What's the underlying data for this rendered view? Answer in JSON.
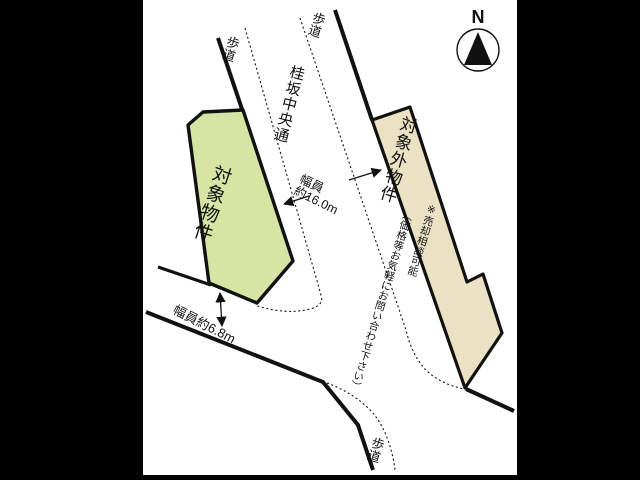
{
  "compass": {
    "north_label": "N"
  },
  "map": {
    "street_name": "桂坂中央通",
    "sidewalk_top_left": "歩道",
    "sidewalk_top_right": "歩道",
    "sidewalk_bottom": "歩道",
    "target_property": {
      "label": "対象物件",
      "fill": "#d7e5a4"
    },
    "excluded_property": {
      "label": "対象外物件",
      "note_col1": "※売却相談可能",
      "note_col2": "（価格等お気軽にお問い合わせ下さい）",
      "fill": "#ebe2c3"
    },
    "width_main": {
      "line1": "幅員",
      "line2": "約16.0m"
    },
    "width_side": "幅員約6.8m",
    "line_color": "#111111"
  }
}
